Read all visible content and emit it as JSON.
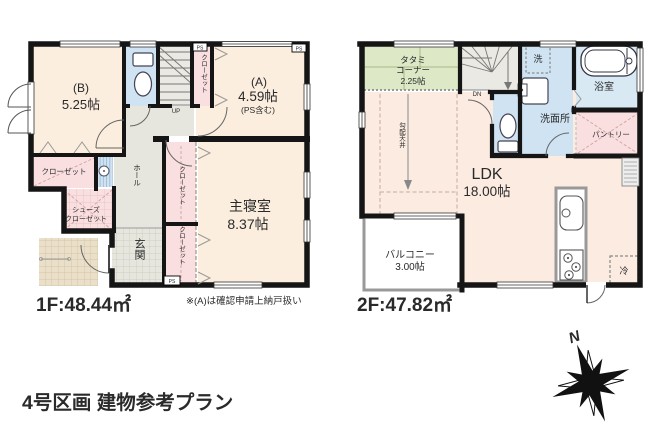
{
  "floor1": {
    "area": "1F:48.44㎡",
    "note": "※(A)は確認申請上納戸扱い",
    "room_b_name": "(B)",
    "room_b_size": "5.25帖",
    "room_a_name": "(A)",
    "room_a_size": "4.59帖",
    "room_a_sub": "(PS含む)",
    "master_name": "主寝室",
    "master_size": "8.37帖",
    "closet": "クローゼット",
    "shoes_line1": "シューズ",
    "shoes_line2": "クローゼット",
    "hall": "ホール",
    "entrance": "玄関",
    "up": "UP",
    "ps": "PS"
  },
  "floor2": {
    "area": "2F:47.82㎡",
    "tatami_line1": "タタミ",
    "tatami_line2": "コーナー",
    "tatami_size": "2.25帖",
    "ldk_name": "LDK",
    "ldk_size": "18.00帖",
    "balcony_name": "バルコニー",
    "balcony_size": "3.00帖",
    "laundry": "洗",
    "bath": "浴室",
    "washroom": "洗面所",
    "pantry": "パントリー",
    "fridge": "冷",
    "sloped_ceiling": "勾配天井",
    "dn": "DN"
  },
  "footer": {
    "title": "4号区画 建物参考プラン"
  },
  "compass": {
    "north": "N"
  },
  "palette": {
    "room": "#fbeedf",
    "closet": "#f9dfe0",
    "water_blue": "#cfe3f2",
    "bath_blue": "#d8e9f4",
    "tatami_green": "#dce8c6",
    "hall_gray": "#e6e6de",
    "stairs_gray": "#eae9e3",
    "porch_beige": "#eadfc9",
    "wall": "#151515"
  }
}
